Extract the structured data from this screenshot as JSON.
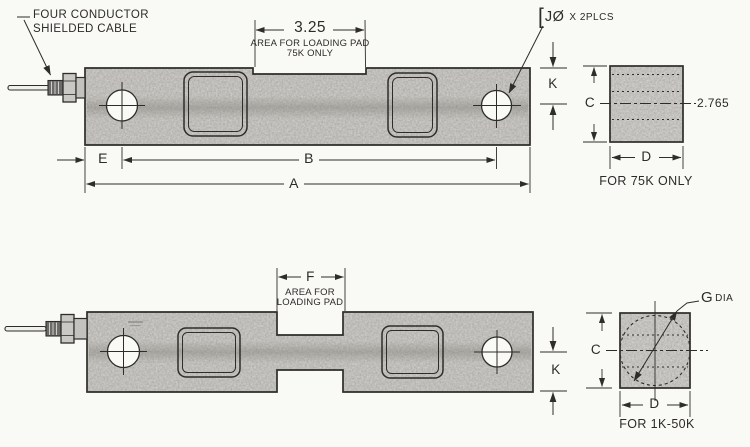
{
  "colors": {
    "ink": "#2f2d2b",
    "metal": "#d7d6d2",
    "metal_light": "#dcdbd7",
    "paper": "#f9f9f6"
  },
  "top_view": {
    "cable_note_line1": "FOUR CONDUCTOR",
    "cable_note_line2": "SHIELDED CABLE",
    "pad_dim": "3.25",
    "pad_note_line1": "AREA FOR LOADING PAD",
    "pad_note_line2": "75K ONLY",
    "hole_callout_bracket": "[",
    "hole_callout_main": "JØ",
    "hole_callout_suffix": "X 2PLCS",
    "dim_e": "E",
    "dim_b": "B",
    "dim_a": "A",
    "dim_k": "K"
  },
  "top_side_view": {
    "dim_c": "C",
    "dim_d": "D",
    "height_value": "2.765",
    "caption": "FOR 75K ONLY"
  },
  "bottom_view": {
    "pad_dim": "F",
    "pad_note_line1": "AREA FOR",
    "pad_note_line2": "LOADING PAD",
    "dim_k": "K"
  },
  "bottom_side_view": {
    "dim_c": "C",
    "dim_d": "D",
    "dim_g": "G",
    "dim_g_suffix": "DIA",
    "caption": "FOR 1K-50K"
  }
}
